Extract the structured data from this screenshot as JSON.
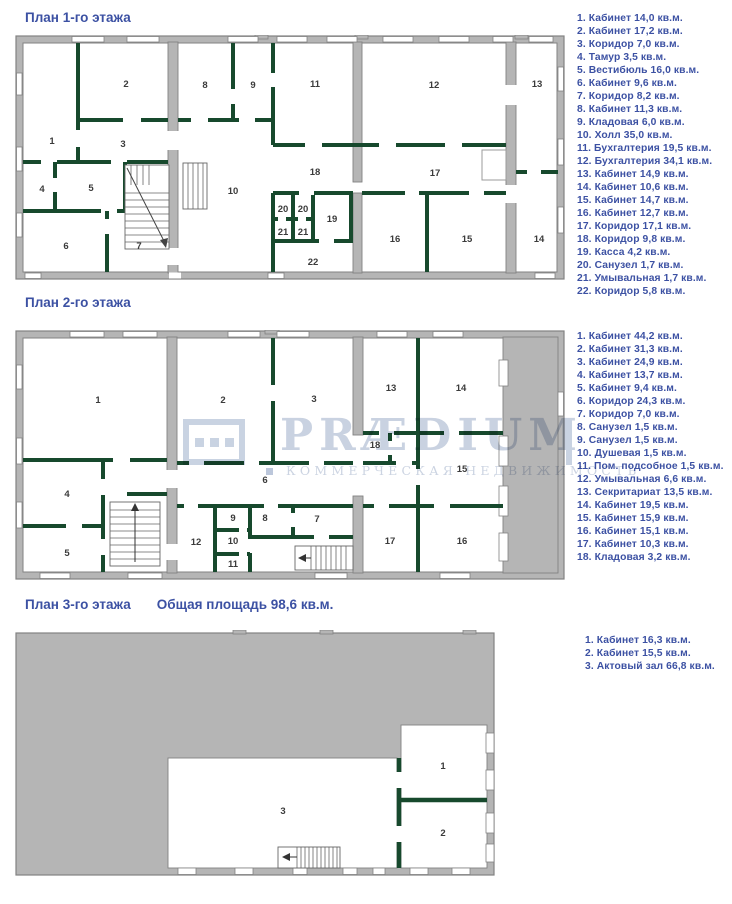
{
  "colors": {
    "text_blue": "#3c51a3",
    "wall_gray": "#b5b5b5",
    "wall_outline": "#828282",
    "partition_green": "#17492d",
    "watermark_blue": "#c9d2e1"
  },
  "watermark": {
    "brand": "PRÆDIUM",
    "tagline": "КОММЕРЧЕСКАЯ НЕДВИЖИМОСТЬ"
  },
  "plans": [
    {
      "title": "План 1-го этажа",
      "rooms": [
        "1",
        "2",
        "3",
        "4",
        "5",
        "6",
        "7",
        "8",
        "9",
        "10",
        "11",
        "12",
        "13",
        "14",
        "15",
        "16",
        "17",
        "18",
        "19",
        "20",
        "21",
        "22"
      ],
      "legend": [
        "1. Кабинет 14,0 кв.м.",
        "2. Кабинет 17,2 кв.м.",
        "3. Коридор 7,0 кв.м.",
        "4. Тамур 3,5 кв.м.",
        "5. Вестибюль 16,0 кв.м.",
        "6. Кабинет 9,6 кв.м.",
        "7. Коридор 8,2 кв.м.",
        "8. Кабинет 11,3 кв.м.",
        "9. Кладовая 6,0 кв.м.",
        "10. Холл 35,0 кв.м.",
        "11. Бухгалтерия 19,5 кв.м.",
        "12. Бухгалтерия 34,1 кв.м.",
        "13. Кабинет 14,9 кв.м.",
        "14. Кабинет 10,6 кв.м.",
        "15. Кабинет 14,7 кв.м.",
        "16. Кабинет 12,7 кв.м.",
        "17. Коридор 17,1 кв.м.",
        "18. Коридор 9,8 кв.м.",
        "19. Касса 4,2 кв.м.",
        "20. Санузел 1,7 кв.м.",
        "21. Умывальная 1,7 кв.м.",
        "22. Коридор 5,8 кв.м."
      ]
    },
    {
      "title": "План 2-го этажа",
      "rooms": [
        "1",
        "2",
        "3",
        "4",
        "5",
        "6",
        "7",
        "8",
        "9",
        "10",
        "11",
        "12",
        "13",
        "14",
        "15",
        "16",
        "17",
        "18"
      ],
      "legend": [
        "1. Кабинет 44,2 кв.м.",
        "2. Кабинет 31,3 кв.м.",
        "3. Кабинет 24,9 кв.м.",
        "4. Кабинет 13,7 кв.м.",
        "5. Кабинет 9,4 кв.м.",
        "6. Коридор 24,3 кв.м.",
        "7. Коридор 7,0 кв.м.",
        "8. Санузел 1,5 кв.м.",
        "9. Санузел 1,5 кв.м.",
        "10. Душевая 1,5 кв.м.",
        "11. Пом. подсобное 1,5 кв.м.",
        "12. Умывальная 6,6 кв.м.",
        "13. Секритариат 13,5 кв.м.",
        "14. Кабинет 19,5 кв.м.",
        "15. Кабинет 15,9 кв.м.",
        "16. Кабинет 15,1 кв.м.",
        "17. Кабинет 10,3 кв.м.",
        "18. Кладовая 3,2 кв.м."
      ]
    },
    {
      "title": "План 3-го этажа",
      "total_area": "Общая площадь 98,6 кв.м.",
      "rooms": [
        "1",
        "2",
        "3"
      ],
      "legend": [
        "1. Кабинет 16,3 кв.м.",
        "2. Кабинет 15,5 кв.м.",
        "3. Актовый зал 66,8 кв.м."
      ]
    }
  ]
}
